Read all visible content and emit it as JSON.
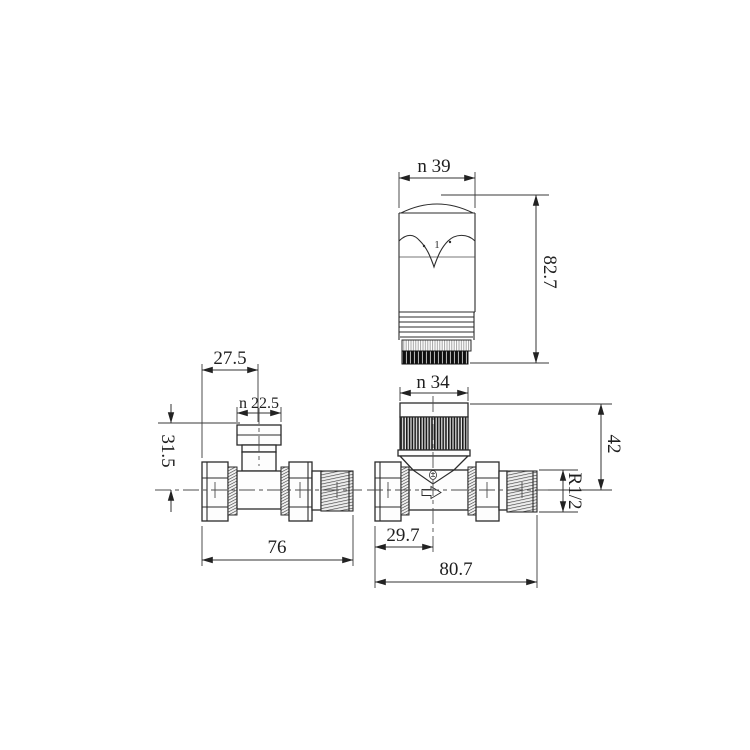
{
  "meta": {
    "subject": "thermostatic radiator valve straight valve set technical drawing",
    "background_color": "#ffffff",
    "line_color": "#2b2b2b",
    "units_shown": "mm"
  },
  "head": {
    "marking": "1"
  },
  "dimensions": {
    "head_diameter": "n 39",
    "head_height": "82.7",
    "collar_diameter": "n 34",
    "body_height": "42",
    "thread_size": "R1/2",
    "body_center_offset": "29.7",
    "body_length": "80.7",
    "lockshield_center_offset": "27.5",
    "tail_diameter": "n 22.5",
    "tail_height": "31.5",
    "lockshield_length": "76"
  }
}
